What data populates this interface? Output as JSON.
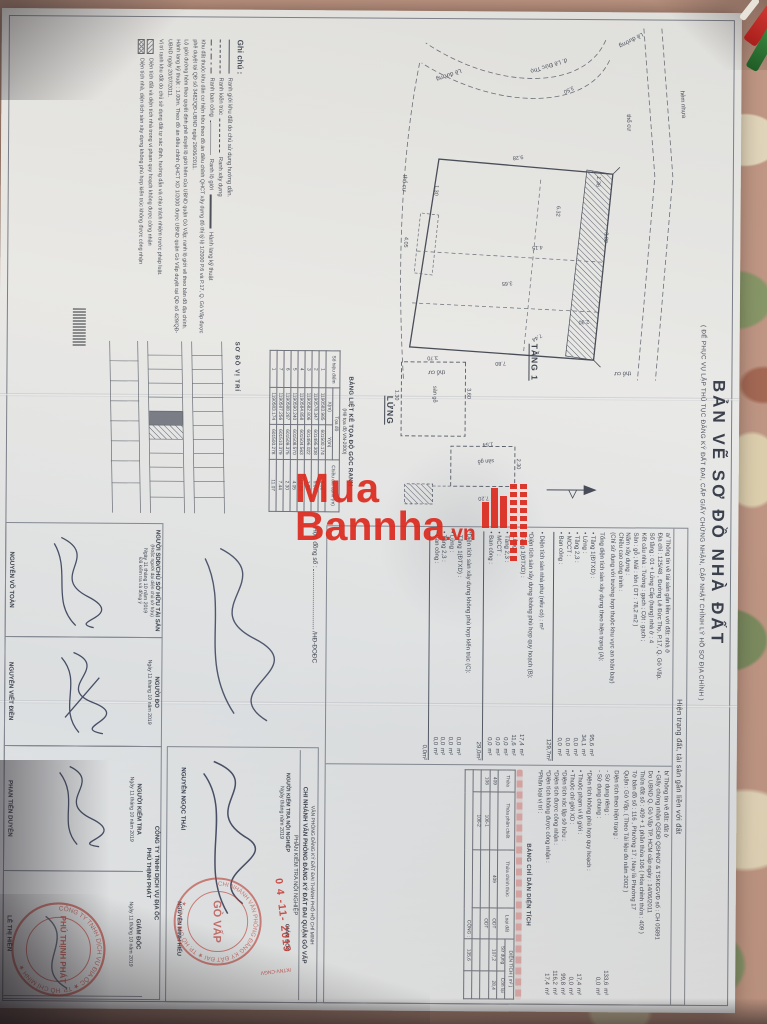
{
  "title": {
    "main": "BẢN VẼ SƠ ĐỒ NHÀ ĐẤT",
    "sub": "( ĐỂ PHỤC VỤ LẬP THỦ TỤC ĐĂNG KÝ ĐẤT ĐAI, CẤP GIẤY CHỨNG NHẬN, CẬP NHẬT CHỈNH LÝ HỒ SƠ ĐỊA CHÍNH )"
  },
  "watermark": {
    "line1": "Mua",
    "line2": "Bannha",
    "suffix": ".vn"
  },
  "plans": {
    "tang1": {
      "label": "TẦNG 1",
      "road1": "hẻm nhựa",
      "road2": "đ. Lê Đức Thọ",
      "curb": "Lề đường",
      "land": "thổ cư",
      "dims": [
        "3.80",
        "2.30",
        "9.28",
        "4.05",
        "7.80",
        "3.65",
        "1.30",
        "7.44",
        "1.36",
        "4.15",
        "3.50",
        "6.32"
      ]
    },
    "lung": {
      "label": "LỬNG",
      "room": "sàn gỗ",
      "dims": [
        "2.30",
        "7.20",
        "1.54",
        "3.60",
        "3.70",
        "1.30"
      ]
    },
    "vitri": {
      "label": "SƠ ĐỒ VỊ TRÍ"
    }
  },
  "coords": {
    "title": "BẢNG LIỆT KÊ TỌA ĐỘ GÓC RANH",
    "subtitle": "(Hệ tọa độ VN-2000)",
    "col_point": "Số hiệu điểm",
    "col_group": "Tọa độ",
    "col_x": "X(m)",
    "col_y": "Y(m)",
    "col_len": "Chiều dài cạnh (m)",
    "rows": [
      [
        "1",
        "1190583.985",
        "601500.174",
        "8.06"
      ],
      [
        "2",
        "1190578.347",
        "601495.308",
        "5.00"
      ],
      [
        "3",
        "1190582.806",
        "601496.022",
        "1.36"
      ],
      [
        "4",
        "1190584.858",
        "601504.563",
        "11.56"
      ],
      [
        "5",
        "1190590.240",
        "601508.570",
        "4.05"
      ],
      [
        "6",
        "1190588.287",
        "601509.375",
        "2.30"
      ],
      [
        "7",
        "1190587.256",
        "601510.379",
        "7.44"
      ],
      [
        "1",
        "1190583.174",
        "601500.278",
        "11.07"
      ]
    ]
  },
  "info": {
    "header": "Hiện trạng đất, tài sản gắn liền với đất",
    "a_lines": [
      "a/ Thông tin về tài sản gắn liền với đất:  nhà ở",
      "Địa chỉ :  125/48 , Đường Lê Đức Thọ, P.17, Q. Gò Vấp.",
      "Số tầng :  01 + Lửng        Cấp (hạng) nhà ở :  4",
      "Kết cấu nhà :  Tường :  gạch  ;  Cột :  gạch ;",
      "Sàn :  gỗ  ;  Mái :  tôn   ( DT : 78,2 m2 )",
      "Năm xây dựng :",
      "Chiều cao công trình :",
      "(Chỉ sử dụng với trường hợp thuộc khu vực an toàn bay)"
    ],
    "areasA": {
      "title": "Tổng diện tích sàn xây dựng theo hiện trạng (A):",
      "items": [
        [
          "• Tầng 1(ĐTXD) :",
          "95,6",
          "m²"
        ],
        [
          "• Lửng :",
          "34,1",
          "m²"
        ],
        [
          "• Tầng 2,3 :",
          "0,0",
          "m²"
        ],
        [
          "• MCCT :",
          "0,0",
          "m²"
        ],
        [
          "• Ban công :",
          "0,0",
          "m²"
        ]
      ],
      "total": "129,7",
      "total_unit": "m²",
      "extra": "• Diện tích sàn nhà phụ (nếu có) :        m²"
    },
    "areasB": {
      "title": "*Diện tích sàn xây dựng không phù hợp quy hoạch (B):",
      "items": [
        [
          "• Tầng 1(ĐTXD) :",
          "17,4",
          "m²"
        ],
        [
          "• Lửng :",
          "11,6",
          "m²"
        ],
        [
          "• Tầng 2,3 :",
          "0,0",
          "m²"
        ],
        [
          "• MCCT :",
          "0,0",
          "m²"
        ],
        [
          "• Ban công :",
          "0,0",
          "m²"
        ]
      ],
      "total": "29,0",
      "total_unit": "m²"
    },
    "areasC": {
      "title": "*Diện tích sàn xây dựng không phù hợp kiến trúc (C):",
      "items": [
        [
          "• Tầng 1(ĐTXD) :",
          "0,0",
          "m²"
        ],
        [
          "• Lửng :",
          "0,0",
          "m²"
        ],
        [
          "• Tầng 2,3 :",
          "0,0",
          "m²"
        ],
        [
          "• Ban công :",
          "0,0",
          "m²"
        ]
      ],
      "total": "0,0",
      "total_unit": "m²"
    },
    "b_lines": [
      "b/ Thông tin về đất:  đất ở",
      "• Giấy chứng nhận QSDĐ QSHNƠ & TSKĐGVĐ số :  CH 05891",
      "Do UBND Q. Gò Vấp TP. HCM cấp ngày :  14/06/2011",
      "Thửa đất số :  409 + 1 phần thửa 106   ( Hòa chỉnh thửa :  409 )",
      "Tờ bản đồ số :  116 , Phường 17  ;  Nay là Phường 17",
      "Quận :  Gò Vấp.   ( Theo Tài liệu đo năm 2002 )"
    ],
    "b_items_title": "Diện tích theo hiện trạng :",
    "b_items": [
      [
        "- Sử dụng riêng :",
        "133,6",
        "m²"
      ],
      [
        "- Sử dụng chung :",
        "0,0",
        "m²"
      ]
    ],
    "b2_title": "*Diện tích không phù hợp quy hoạch :",
    "b2_items": [
      [
        "• Thuộc phạm vi lộ giới :",
        "17,4",
        "m²"
      ],
      [
        "• Thuộc chỉ giới XD :",
        "0,0",
        "m²"
      ],
      [
        "*Diện tích xác lập sở hữu :",
        "99,8",
        "m²"
      ],
      [
        "*Diện tích được công nhận :",
        "116,2",
        "m²"
      ],
      [
        "*Diện tích không được công nhận :",
        "17,4",
        "m²"
      ],
      [
        "*Phân loại vị trí :",
        "",
        ""
      ]
    ]
  },
  "areaTable": {
    "title": "BẢNG CHỈ DẪN DIỆN TÍCH",
    "col_thua": "Thửa",
    "col_chiet": "Thửa phân chiết",
    "col_chinh": "Thửa chính thức",
    "col_loai": "Loại đất",
    "col_dt": "DIỆN TÍCH ( m² )",
    "col_sd": "Sử dụng",
    "col_cl": "Còn lại",
    "rows": [
      [
        "409",
        "",
        "409",
        "ODT",
        "107,2",
        "28,4"
      ],
      [
        "106",
        "106-1",
        "",
        "ODT",
        "",
        ""
      ],
      [
        "",
        "106-2",
        "",
        "",
        "",
        ""
      ]
    ],
    "sum_label": "CỘNG :",
    "sum_sd": "135,6",
    "sum_cl": ""
  },
  "legend": {
    "title": "Ghi chú :",
    "sym1": "Ranh giới khu đất do chủ sử dụng hướng dẫn.",
    "sym2": "Ranh kiến trúc",
    "sym3": "Ranh xây dựng",
    "sym4": "Ranh ban công",
    "sym5": "Ranh lộ giới",
    "sym6": "Hành lang kỹ thuật",
    "notes": [
      "Khu đất thuộc khu dân cư hiện hữu theo đồ án điều chỉnh QHCT xây dựng đô thị tỷ lệ 1/2000 P.6 và P.17, Q. Gò Vấp được phê duyệt tại QĐ số 3482/QĐ-UBND ngày 29/06/2011.",
      "Lộ giới đường hẻm theo quyết định phê duyệt lộ giới hẻm của UBND quận Gò Vấp; ranh lộ giới vẽ theo bản đồ địa chính.",
      "Hành lang kỹ thuật : 1.00m. Theo đồ án điều chỉnh QHCT XD 1/2000 được UBND quận Gò Vấp duyệt tại QĐ số 429/QĐ-UBND ngày 20/07/2011.",
      "Vị trí ranh khu đất do chủ sử dụng đất tự xác định, hướng dẫn và chịu trách nhiệm trước pháp luật."
    ],
    "hatch1": "Diện tích đất và diện tích nhà trong vi phạm quy hoạch không được công nhận",
    "hatch2": "Diện tích nhà, diện tích sàn xây dựng không phù hợp kiến trúc không được công nhận"
  },
  "sigs": {
    "contract_label": "Hợp đồng số :",
    "contract_suffix": "/HĐ-ĐOĐC",
    "vp1": "VĂN PHÒNG ĐĂNG KÝ ĐẤT ĐAI THÀNH PHỐ HỒ CHÍ MINH",
    "vp2": "CHI NHÁNH VĂN PHÒNG ĐĂNG KÝ ĐẤT ĐAI QUẬN GÒ VẤP",
    "vp3": "PHẦN KIỂM TRA NỘI NGHIỆP",
    "col_ktnn": "NGƯỜI KIỂM TRA NỘI NGHIỆP",
    "ktnn_date": "Ngày        tháng        năm 2019",
    "ktnn_name": "NGUYỄN NGỌC THÁI",
    "col_gd1": "GIÁM ĐỐC",
    "gd1_name": "NGUYỄN MINH HIẾU",
    "col_sdd": "NGƯỜI SDĐ/CHỦ SỞ HỮU TÀI SẢN",
    "col_sdd_sub": "(Hoặc người đại diện chủ sở hữu)",
    "sdd_date": "Ngày 11 tháng 10 năm 2019",
    "sdd_note": "Đã kiểm tra và đồng ý",
    "sdd_name": "NGUYỄN VÕ TOÀN",
    "col_do": "NGƯỜI ĐO",
    "do_date": "Ngày 11 tháng 10 năm 2019",
    "do_name": "NGUYỄN VIẾT ĐIỀN",
    "company1": "CÔNG TY TNHH DỊCH VỤ ĐỊA ỐC",
    "company2": "PHÚ THỊNH PHÁT",
    "col_kt": "NGƯỜI KIỂM TRA",
    "kt_date": "Ngày 11 tháng 10 năm 2019",
    "kt_name": "PHAN TIẾN DUYÊN",
    "col_gd2": "GIÁM ĐỐC",
    "gd2_date": "Ngày 11 tháng 10 năm 2019",
    "gd2_name": "LÊ THỊ HIỀN"
  },
  "stamps": {
    "date": "0 4 -11- 2019",
    "ref": "/KTNV-CNGV",
    "govap": {
      "arc": "CHI NHÁNH VĂN PHÒNG ĐĂNG KÝ ĐẤT ĐAI ★ TP. HỒ CHÍ MINH ★",
      "center": "GÒ VẤP"
    },
    "company": {
      "arc": "CÔNG TY TNHH DỊCH VỤ ĐỊA ỐC ★ TP. HỒ CHÍ MINH ★",
      "center": "PHÚ THỊNH PHÁT"
    }
  }
}
